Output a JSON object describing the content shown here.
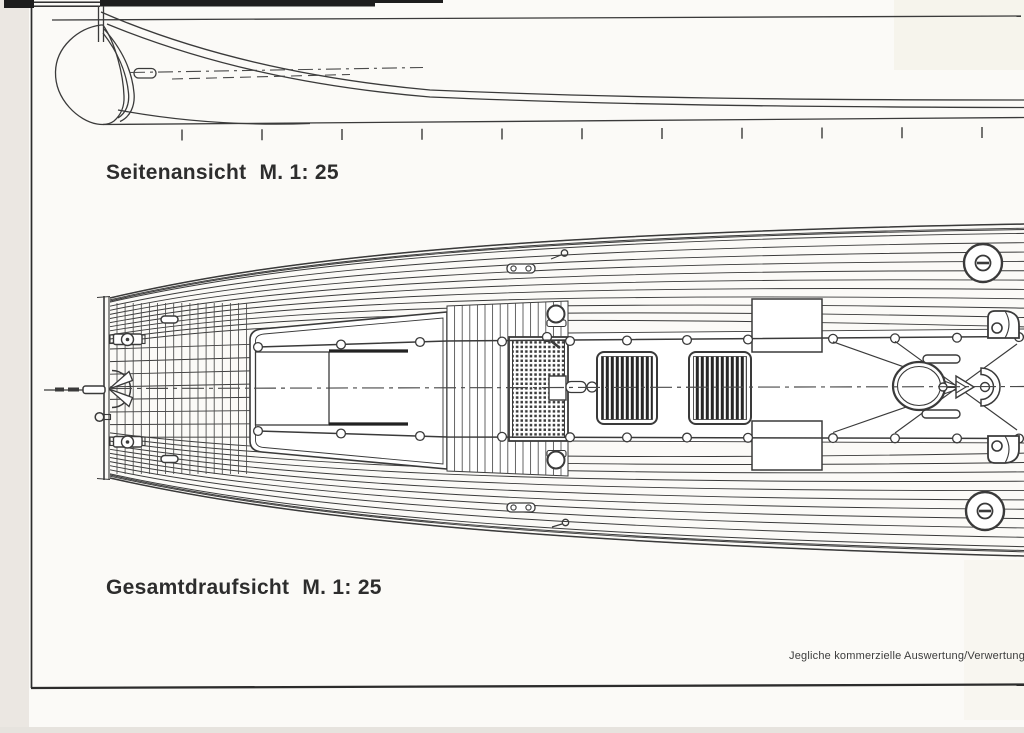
{
  "document": {
    "views": [
      {
        "id": "side-view",
        "title": "Seitenansicht",
        "scale": "M. 1: 25"
      },
      {
        "id": "plan-view",
        "title": "Gesamtdraufsicht",
        "scale": "M. 1: 25"
      }
    ],
    "footer_note": "Jegliche kommerzielle Auswertung/Verwertung",
    "colors": {
      "ink": "#383838",
      "paper": "#fbfaf7"
    }
  }
}
